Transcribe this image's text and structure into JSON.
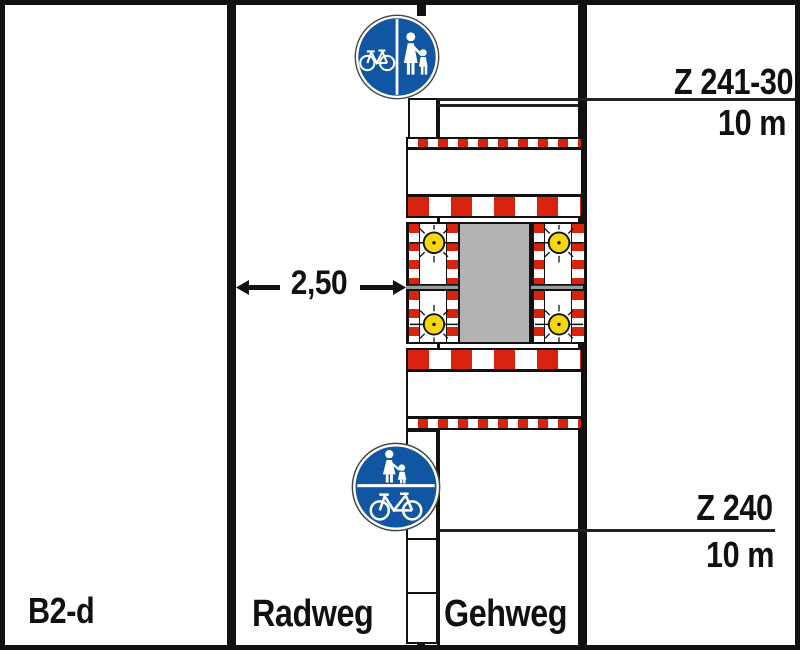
{
  "plan": {
    "label": "B2-d"
  },
  "lanes": {
    "cycle": "Radweg",
    "foot": "Gehweg"
  },
  "dimension": {
    "width_label": "2,50"
  },
  "signs": {
    "top": {
      "ref": "Z 241-30",
      "distance": "10 m",
      "meaning": "separated cycle and foot path"
    },
    "bottom": {
      "ref": "Z 240",
      "distance": "10 m",
      "meaning": "shared foot and cycle path"
    }
  },
  "colors": {
    "sign_blue": "#1156a2",
    "barrier_red": "#d9230f",
    "lamp_yellow": "#f4d70e",
    "work_area_gray": "#b3b3b3"
  }
}
